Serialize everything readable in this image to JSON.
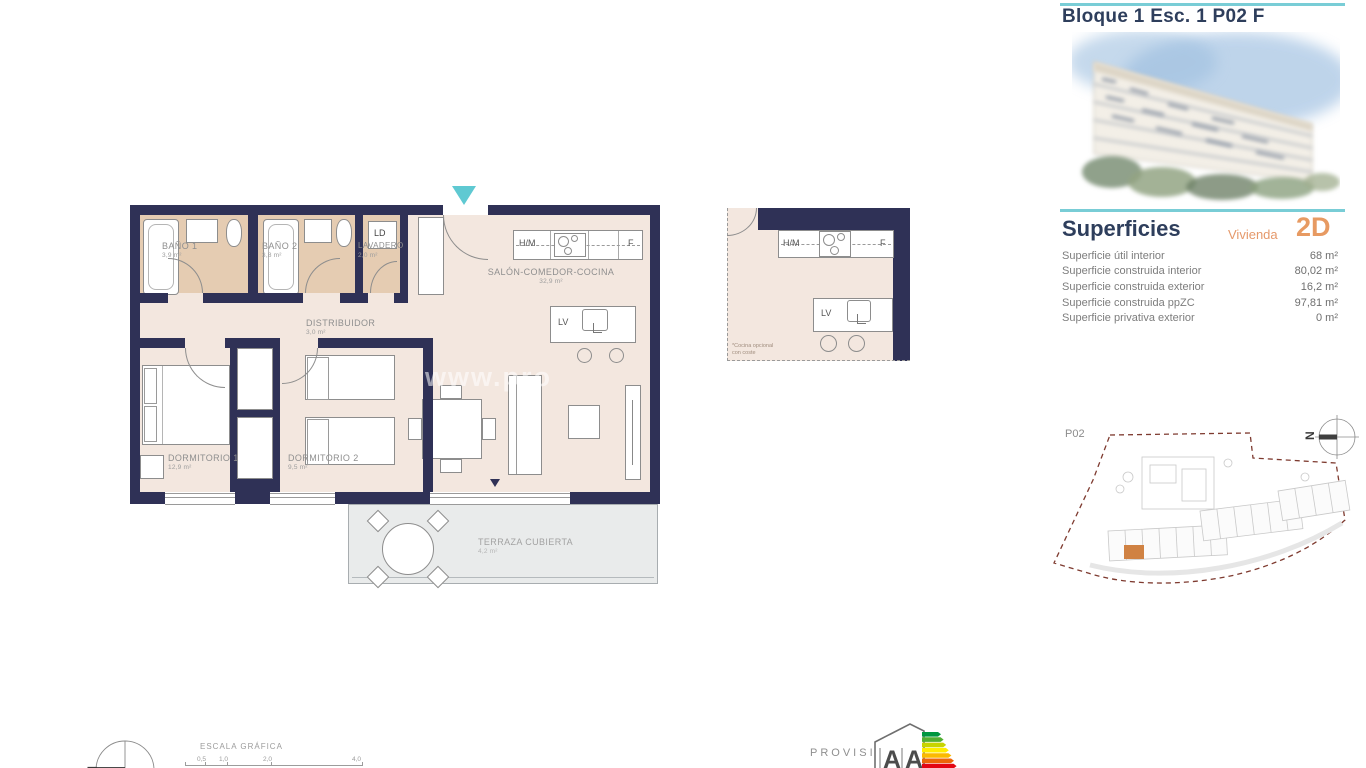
{
  "header": {
    "title": "Bloque 1 Esc. 1 P02 F"
  },
  "superficies": {
    "heading": "Superficies",
    "vivienda_label": "Vivienda",
    "vivienda_code": "2D",
    "rows": [
      {
        "label": "Superficie útil interior",
        "value": "68 m²"
      },
      {
        "label": "Superficie construida interior",
        "value": "80,02 m²"
      },
      {
        "label": "Superficie construida exterior",
        "value": "16,2 m²"
      },
      {
        "label": "Superficie construida ppZC",
        "value": "97,81 m²"
      },
      {
        "label": "Superficie privativa exterior",
        "value": "0 m²"
      }
    ]
  },
  "plan": {
    "rooms": {
      "bano1": {
        "name": "BAÑO 1",
        "area": "3,9 m²"
      },
      "bano2": {
        "name": "BAÑO 2",
        "area": "3,8 m²"
      },
      "lavadero": {
        "name": "LAVADERO",
        "area": "2,0 m²"
      },
      "distribuidor": {
        "name": "DISTRIBUIDOR",
        "area": "3,0 m²"
      },
      "salon": {
        "name": "SALÓN-COMEDOR-COCINA",
        "area": "32,9 m²"
      },
      "dorm1": {
        "name": "DORMITORIO 1",
        "area": "12,9 m²"
      },
      "dorm2": {
        "name": "DORMITORIO 2",
        "area": "9,5 m²"
      },
      "terraza": {
        "name": "TERRAZA CUBIERTA",
        "area": "4,2 m²"
      }
    },
    "appliances": {
      "hm": "H/M",
      "f": "F",
      "lv": "LV",
      "ld": "LD"
    },
    "watermark": "www.pro"
  },
  "kitchen_detail": {
    "hm": "H/M",
    "f": "F",
    "lv": "LV",
    "note_line1": "*Cocina opcional",
    "note_line2": "con coste"
  },
  "siteplan": {
    "floor": "P02"
  },
  "compass": {
    "north": "N"
  },
  "footer": {
    "scale_heading": "ESCALA GRÁFICA",
    "scale_ticks": [
      "0,5",
      "1,0",
      "2,0",
      "4,0"
    ],
    "provisional": "PROVISIONAL"
  },
  "energy": {
    "letters": [
      "A",
      "A"
    ]
  },
  "colors": {
    "wall": "#2f3156",
    "teal": "#5fc9d2",
    "orange": "#e79a62",
    "navy_text": "#2e3e5c",
    "bath_floor": "#e5ccb2",
    "interior_floor": "#f3e7df",
    "terrace_floor": "#e9ebeb",
    "site_boundary": "#7e3a2f",
    "energy_bars": [
      "#009640",
      "#52ae32",
      "#c8d400",
      "#ffed00",
      "#fbba00",
      "#ec6608",
      "#e30613"
    ]
  }
}
